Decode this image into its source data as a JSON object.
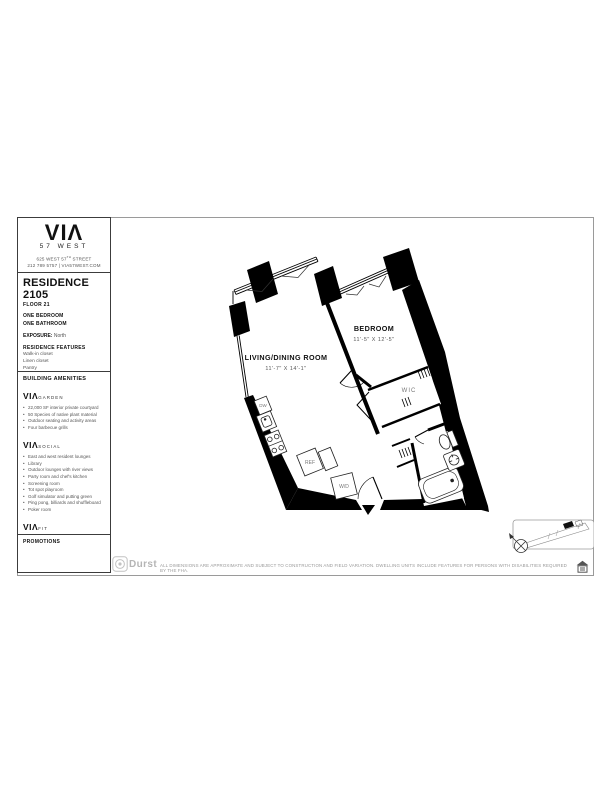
{
  "brand": {
    "logo": "VIΛ",
    "name": "57 WEST",
    "address_pre": "625 WEST 57",
    "address_sup": "TH",
    "address_post": " STREET",
    "contact": "212 789 5757 | VIA57WEST.COM"
  },
  "residence": {
    "title": "RESIDENCE 2105",
    "floor": "FLOOR 21",
    "bedrooms": "ONE BEDROOM",
    "bathrooms": "ONE BATHROOM",
    "exposure_label": "EXPOSURE:",
    "exposure_value": "North",
    "features_header": "RESIDENCE FEATURES",
    "features": [
      "Walk-in closet",
      "Linen closet",
      "Pantry",
      "Optional kitchen island",
      "Washer/Dryer"
    ],
    "rent_header": "MONTHLY RENT"
  },
  "amenities": {
    "header": "BUILDING AMENITIES",
    "groups": [
      {
        "brand": "VIΛ",
        "name": "GARDEN",
        "items": [
          "22,000 SF interior private courtyard",
          "50 Species of native plant material",
          "Outdoor seating and activity areas",
          "Four barbecue grills"
        ]
      },
      {
        "brand": "VIΛ",
        "name": "SOCIAL",
        "items": [
          "East and west resident lounges",
          "Library",
          "Outdoor lounges with river views",
          "Party room and chef's kitchen",
          "Screening room",
          "Tot spot playroom",
          "Golf simulator and putting green",
          "Ping pong, billiards and shuffleboard",
          "Poker room"
        ]
      },
      {
        "brand": "VIΛ",
        "name": "FIT",
        "items": [
          "High-performance gym equipment",
          "Wellness lounge",
          "Swimming pool and sun decks",
          "Exercise and spin studios",
          "Indoor half-court basketball"
        ]
      }
    ]
  },
  "promotions": {
    "header": "PROMOTIONS"
  },
  "floorplan": {
    "living": {
      "name": "LIVING/DINING ROOM",
      "dims": "11'-7\" X 14'-1\""
    },
    "bedroom": {
      "name": "BEDROOM",
      "dims": "11'-5\" X 12'-5\""
    },
    "wic": "WIC",
    "dw": "DW",
    "ref": "REF",
    "wd": "W/D"
  },
  "footer": {
    "durst": "Durst",
    "disclaimer": "ALL DIMENSIONS ARE APPROXIMATE AND SUBJECT TO CONSTRUCTION AND FIELD VARIATION.  DWELLING UNITS INCLUDE FEATURES FOR PERSONS WITH DISABILITIES REQUIRED BY THE FHA."
  },
  "colors": {
    "ink": "#000000",
    "frame": "#9a9a9a",
    "muted": "#555555",
    "light": "#b5b5b5"
  }
}
